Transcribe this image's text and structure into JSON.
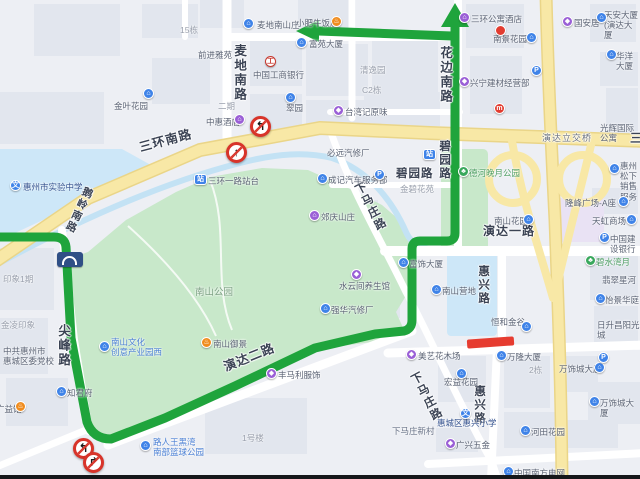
{
  "map": {
    "colors": {
      "route_green": "#1fa43c",
      "closure_red": "#e63c30",
      "major_road_yellow": "#f8e8a6",
      "water_blue": "#cde7f8",
      "park_green": "#c8e8ca",
      "land": "#edeff4"
    },
    "road_labels": [
      {
        "t": "三环南路",
        "x": 138,
        "y": 142,
        "s": 12.5,
        "r": -15
      },
      {
        "t": "三",
        "x": 630,
        "y": 132,
        "s": 12
      },
      {
        "t": "麦地南路",
        "x": 232,
        "y": 44,
        "s": 12.5,
        "v": 1
      },
      {
        "t": "花边南路",
        "x": 438,
        "y": 46,
        "s": 12.5,
        "v": 1
      },
      {
        "t": "碧园路",
        "x": 438,
        "y": 140,
        "s": 11.5,
        "v": 1
      },
      {
        "t": "碧园路",
        "x": 396,
        "y": 168,
        "s": 11.5
      },
      {
        "t": "下马庄路",
        "x": 352,
        "y": 186,
        "s": 11.5,
        "v": 1,
        "r": -28
      },
      {
        "t": "下马庄路",
        "x": 408,
        "y": 376,
        "s": 11.5,
        "v": 1,
        "r": -28
      },
      {
        "t": "演达一路",
        "x": 483,
        "y": 225,
        "s": 12
      },
      {
        "t": "演达二路",
        "x": 222,
        "y": 362,
        "s": 12.5,
        "r": -22
      },
      {
        "t": "尖峰路",
        "x": 56,
        "y": 324,
        "s": 12.5,
        "v": 1
      },
      {
        "t": "惠兴路",
        "x": 477,
        "y": 265,
        "s": 11.5,
        "v": 1
      },
      {
        "t": "惠兴路",
        "x": 473,
        "y": 385,
        "s": 11.5,
        "v": 1
      },
      {
        "t": "演达立交桥",
        "x": 542,
        "y": 134,
        "s": 9,
        "c": "#6b7280",
        "w": 400
      },
      {
        "t": "鹅岭南路",
        "x": 84,
        "y": 185,
        "s": 10.5,
        "v": 1,
        "r": 25
      }
    ],
    "pois": [
      {
        "t": "金叶花园",
        "x": 114,
        "y": 101,
        "i": "building",
        "ix": 143,
        "iy": 88
      },
      {
        "t": "15栋",
        "x": 180,
        "y": 25,
        "c": "#9aa0ad"
      },
      {
        "t": "前进雅苑",
        "x": 198,
        "y": 50
      },
      {
        "t": "麦地南山庄",
        "x": 257,
        "y": 20,
        "i": "building",
        "ix": 243,
        "iy": 18
      },
      {
        "t": "小肥牛饭店",
        "x": 296,
        "y": 18,
        "i": "restaurant",
        "ix": 331,
        "iy": 16
      },
      {
        "t": "富苑大厦",
        "x": 309,
        "y": 39,
        "i": "building",
        "ix": 296,
        "iy": 37
      },
      {
        "t": "清逸园",
        "x": 360,
        "y": 65,
        "c": "#9aa0ad"
      },
      {
        "t": "C2栋",
        "x": 362,
        "y": 85,
        "c": "#9aa0ad"
      },
      {
        "t": "二期",
        "x": 218,
        "y": 101,
        "c": "#9aa0ad"
      },
      {
        "t": "中国工商银行",
        "x": 253,
        "y": 70,
        "i": "bank",
        "ix": 265,
        "iy": 56
      },
      {
        "t": "中惠酒店",
        "x": 206,
        "y": 117,
        "i": "hotel",
        "ix": 234,
        "iy": 114
      },
      {
        "t": "翠园",
        "x": 286,
        "y": 103,
        "i": "building",
        "ix": 285,
        "iy": 92
      },
      {
        "t": "台湾记原味",
        "x": 345,
        "y": 107,
        "i": "shopping",
        "ix": 333,
        "iy": 105
      },
      {
        "t": "三环公寓酒店",
        "x": 471,
        "y": 14,
        "i": "hotel",
        "ix": 459,
        "iy": 12
      },
      {
        "t": "国安居",
        "x": 574,
        "y": 18,
        "i": "shopping",
        "ix": 562,
        "iy": 16
      },
      {
        "t": "天安大厦\n(演达大厦",
        "x": 604,
        "y": 10,
        "i": "building",
        "ix": 596,
        "iy": 12
      },
      {
        "t": "南景花园",
        "x": 493,
        "y": 34,
        "i": "building",
        "ix": 526,
        "iy": 32
      },
      {
        "t": "华洋大厦",
        "x": 616,
        "y": 51,
        "i": "building",
        "ix": 606,
        "iy": 49
      },
      {
        "t": "兴宁建材经营部",
        "x": 470,
        "y": 78,
        "i": "shopping",
        "ix": 459,
        "iy": 76
      },
      {
        "t": "光辉国际公寓",
        "x": 600,
        "y": 123
      },
      {
        "t": "惠州松下\n销售服务",
        "x": 620,
        "y": 161,
        "i": "building",
        "ix": 609,
        "iy": 163
      },
      {
        "t": "惠州市实验中学",
        "x": 23,
        "y": 182,
        "c": "#33518e",
        "i": "school",
        "ix": 10,
        "iy": 180
      },
      {
        "t": "三环一路站台",
        "x": 208,
        "y": 176,
        "i": "busstop",
        "ix": 194,
        "iy": 174
      },
      {
        "t": "德河晚月公园",
        "x": 469,
        "y": 168,
        "c": "#4d9e63",
        "i": "park",
        "ix": 458,
        "iy": 166
      },
      {
        "t": "金碧花苑",
        "x": 400,
        "y": 184,
        "c": "#9aa0ad"
      },
      {
        "t": "南山花园",
        "x": 494,
        "y": 216,
        "i": "building",
        "ix": 523,
        "iy": 214
      },
      {
        "t": "隆峰广场-A座",
        "x": 565,
        "y": 198,
        "i": "building",
        "ix": 618,
        "iy": 196
      },
      {
        "t": "天虹商场",
        "x": 592,
        "y": 216,
        "i": "building",
        "ix": 626,
        "iy": 214
      },
      {
        "t": "中国建设银行",
        "x": 610,
        "y": 234,
        "i": "parking",
        "ix": 599,
        "iy": 232
      },
      {
        "t": "郊庆山庄",
        "x": 321,
        "y": 212,
        "i": "hotel",
        "ix": 309,
        "iy": 210
      },
      {
        "t": "成记汽车服务部",
        "x": 328,
        "y": 175,
        "i": "building",
        "ix": 317,
        "iy": 173
      },
      {
        "t": "必远汽修厂",
        "x": 327,
        "y": 148
      },
      {
        "t": "水云间养生馆",
        "x": 339,
        "y": 281,
        "i": "shopping",
        "ix": 351,
        "iy": 269
      },
      {
        "t": "强华汽修厂",
        "x": 331,
        "y": 305,
        "i": "building",
        "ix": 320,
        "iy": 303
      },
      {
        "t": "南山公园",
        "x": 195,
        "y": 287,
        "c": "#7da184",
        "s": 9.5
      },
      {
        "t": "南山文化\n创意产业园西",
        "x": 111,
        "y": 337,
        "c": "#4a7fd4",
        "i": "building",
        "ix": 99,
        "iy": 341
      },
      {
        "t": "中共惠州市\n惠城区委党校",
        "x": 3,
        "y": 346
      },
      {
        "t": "知君府",
        "x": 67,
        "y": 388,
        "i": "building",
        "ix": 56,
        "iy": 386
      },
      {
        "t": "广益馆",
        "x": -4,
        "y": 404,
        "i": "restaurant",
        "ix": 15,
        "iy": 401
      },
      {
        "t": "路人王黑湾\n南部篮球公园",
        "x": 153,
        "y": 437,
        "c": "#4a7fd4",
        "i": "building",
        "ix": 140,
        "iy": 440
      },
      {
        "t": "1号楼",
        "x": 242,
        "y": 433,
        "c": "#9aa0ad"
      },
      {
        "t": "南山御景",
        "x": 213,
        "y": 339,
        "i": "restaurant",
        "ix": 201,
        "iy": 337
      },
      {
        "t": "丰马利服饰",
        "x": 278,
        "y": 370,
        "i": "shopping",
        "ix": 266,
        "iy": 368
      },
      {
        "t": "美艺花木场",
        "x": 418,
        "y": 351,
        "i": "shopping",
        "ix": 406,
        "iy": 349
      },
      {
        "t": "下马庄新村",
        "x": 392,
        "y": 426,
        "c": "#667085"
      },
      {
        "t": "南山营地",
        "x": 442,
        "y": 286,
        "i": "building",
        "ix": 431,
        "iy": 284
      },
      {
        "t": "富饰大厦",
        "x": 409,
        "y": 259,
        "i": "building",
        "ix": 398,
        "iy": 257
      },
      {
        "t": "恒和金谷",
        "x": 491,
        "y": 317,
        "i": "building",
        "ix": 521,
        "iy": 321
      },
      {
        "t": "翡翠星河",
        "x": 602,
        "y": 275
      },
      {
        "t": "怡景华庭",
        "x": 605,
        "y": 295,
        "i": "building",
        "ix": 595,
        "iy": 293
      },
      {
        "t": "碧水湾月",
        "x": 596,
        "y": 257,
        "c": "#4d9e63",
        "i": "park",
        "ix": 585,
        "iy": 255
      },
      {
        "t": "日升昌阳光城",
        "x": 597,
        "y": 320
      },
      {
        "t": "万隆大厦",
        "x": 507,
        "y": 352,
        "i": "building",
        "ix": 496,
        "iy": 350
      },
      {
        "t": "2栋",
        "x": 529,
        "y": 365,
        "c": "#9aa0ad"
      },
      {
        "t": "万饰城大厦",
        "x": 559,
        "y": 364,
        "i": "building",
        "ix": 594,
        "iy": 362
      },
      {
        "t": "万饰城大厦",
        "x": 600,
        "y": 398,
        "i": "building",
        "ix": 589,
        "iy": 396
      },
      {
        "t": "河田花园",
        "x": 531,
        "y": 427,
        "i": "building",
        "ix": 520,
        "iy": 425
      },
      {
        "t": "广兴五金",
        "x": 456,
        "y": 440,
        "i": "shopping",
        "ix": 445,
        "iy": 438
      },
      {
        "t": "惠城区惠兴小学",
        "x": 437,
        "y": 418,
        "c": "#33518e",
        "i": "school",
        "ix": 460,
        "iy": 408
      },
      {
        "t": "宏益花园",
        "x": 444,
        "y": 377,
        "i": "building",
        "ix": 456,
        "iy": 368
      },
      {
        "t": "中国南方电网",
        "x": 514,
        "y": 468,
        "i": "building",
        "ix": 503,
        "iy": 466
      },
      {
        "t": "印象1期",
        "x": 3,
        "y": 274,
        "c": "#9aa0ad"
      },
      {
        "t": "金凌印象",
        "x": 1,
        "y": 320,
        "c": "#9aa0ad"
      }
    ],
    "icons": [
      {
        "i": "marker",
        "x": 495,
        "y": 25
      },
      {
        "i": "fastfood",
        "x": 494,
        "y": 103
      },
      {
        "i": "parking",
        "x": 374,
        "y": 169
      },
      {
        "i": "parking",
        "x": 531,
        "y": 65
      },
      {
        "i": "parking",
        "x": 598,
        "y": 352
      },
      {
        "i": "busstop",
        "x": 423,
        "y": 149
      }
    ],
    "signs": [
      {
        "type": "no-left-turn",
        "x": 250,
        "y": 116
      },
      {
        "type": "no-straight",
        "x": 226,
        "y": 142
      },
      {
        "type": "no-left-turn",
        "x": 73,
        "y": 438
      },
      {
        "type": "no-right-turn",
        "x": 83,
        "y": 452
      }
    ],
    "bridge_icon": {
      "x": 57,
      "y": 252,
      "w": 26,
      "h": 15
    }
  }
}
